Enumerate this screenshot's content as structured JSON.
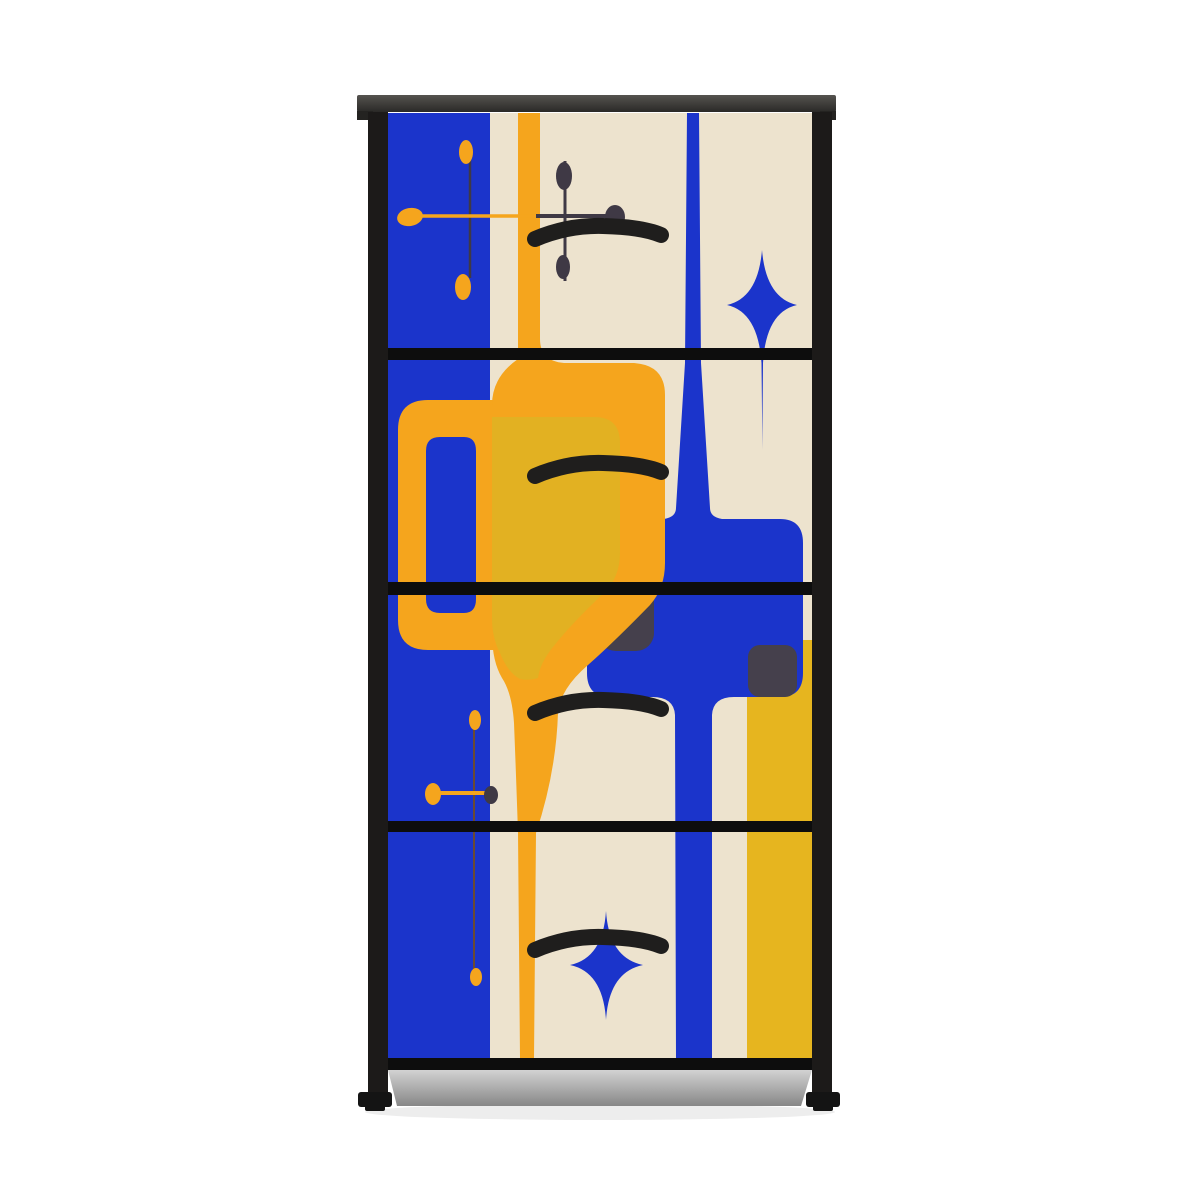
{
  "scene": {
    "type": "product-photo",
    "subject": "four-drawer dresser with mid-century abstract atomic-pattern drawer fronts",
    "drawer_count": 4,
    "handle_count": 4,
    "drawers": [
      {
        "name": "drawer-1",
        "position": "top"
      },
      {
        "name": "drawer-2",
        "position": "upper-middle"
      },
      {
        "name": "drawer-3",
        "position": "lower-middle"
      },
      {
        "name": "drawer-4",
        "position": "bottom"
      }
    ],
    "art_motifs": [
      "blue-left-column",
      "orange-vertical-stripe",
      "blue-stripe-paddle",
      "orange-rounded-frame",
      "mustard-inner-panel",
      "dark-slate-accents",
      "yellow-right-column",
      "atomic-starburst-crosses",
      "four-point-sparkle-stars"
    ]
  },
  "colors": {
    "background": "#ffffff",
    "shadow": "#000000",
    "slab_light": "#55534f",
    "slab_dark": "#2a2927",
    "slab_lip": "#242321",
    "post": "#1c1a19",
    "art_bg": "#ede3ce",
    "blue": "#1b34cb",
    "orange": "#f5a51d",
    "mustard": "#e2b122",
    "yellow": "#e6b51f",
    "slate": "#45404c",
    "cross_dark": "#3f3945",
    "rust_stem": "#6a4a33",
    "handle": "#1f1e1d",
    "divider": "#0d0d0d",
    "base_light": "#d2d2d2",
    "base_dark": "#878787",
    "foot": "#141414",
    "transparent": "transparent"
  }
}
